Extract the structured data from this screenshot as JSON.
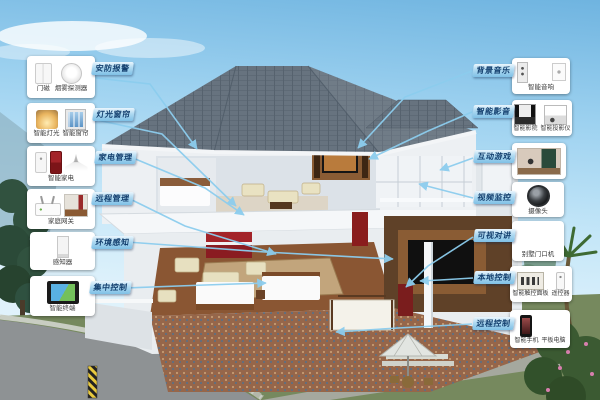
{
  "colors": {
    "label_text": "#14406f",
    "label_bg": "#9fd0ee",
    "connector": "#8ccdee",
    "box_bg": "#ffffff",
    "roof": "#67737f",
    "sky": "#9ed2f0"
  },
  "callouts": {
    "left": [
      {
        "id": "security",
        "label": "安防报警",
        "captions": [
          "门磁",
          "烟雾探测器"
        ]
      },
      {
        "id": "lighting",
        "label": "灯光窗帘",
        "captions": [
          "智能灯光",
          "智能窗帘"
        ]
      },
      {
        "id": "appliance",
        "label": "家电管理",
        "captions": [
          "智能家电"
        ]
      },
      {
        "id": "gateway",
        "label": "远程管理",
        "captions": [
          "家庭网关"
        ]
      },
      {
        "id": "sensing",
        "label": "环境感知",
        "captions": [
          "感知器"
        ]
      },
      {
        "id": "central",
        "label": "集中控制",
        "captions": [
          "智能终端"
        ]
      }
    ],
    "right": [
      {
        "id": "music",
        "label": "背景音乐",
        "captions": [
          "智能音响"
        ]
      },
      {
        "id": "av",
        "label": "智能影音",
        "captions": [
          "智能影院",
          "智能投影仪"
        ]
      },
      {
        "id": "game",
        "label": "互动游戏",
        "captions": []
      },
      {
        "id": "cctv",
        "label": "视频监控",
        "captions": [
          "摄像头"
        ]
      },
      {
        "id": "intercom",
        "label": "可视对讲",
        "captions": [
          "别墅门口机"
        ]
      },
      {
        "id": "local",
        "label": "本地控制",
        "captions": [
          "智能触控面板",
          "遥控器"
        ]
      },
      {
        "id": "remote",
        "label": "远程控制",
        "captions": [
          "智能手机",
          "平板电脑"
        ]
      }
    ]
  }
}
